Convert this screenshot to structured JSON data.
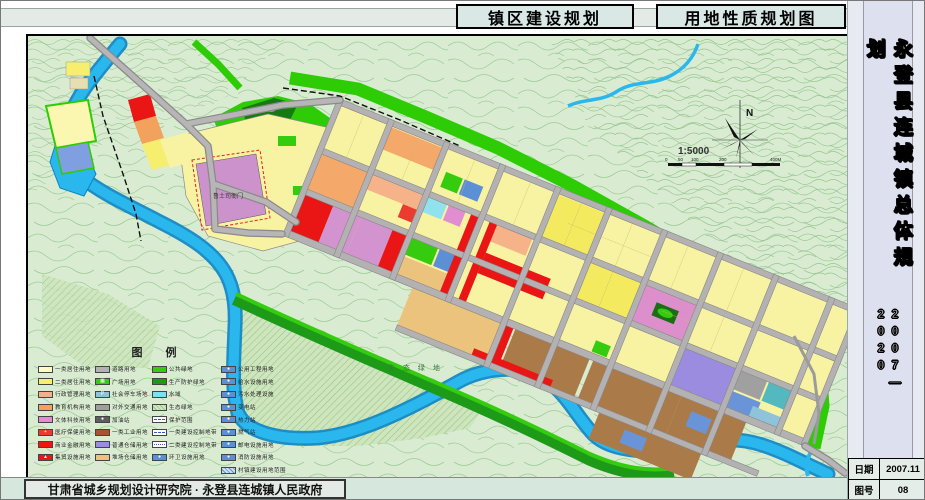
{
  "header": {
    "tabs": [
      {
        "label": "镇区建设规划"
      },
      {
        "label": "用地性质规划图"
      }
    ]
  },
  "titleblock": {
    "vertical_title": "永登县连城镇总体规划",
    "period": "2007—2020",
    "rows": [
      {
        "label": "日期",
        "value": "2007.11"
      },
      {
        "label": "图号",
        "value": "08"
      }
    ]
  },
  "footer": {
    "credit": "甘肃省城乡规划设计研究院 · 永登县连城镇人民政府"
  },
  "map": {
    "labels": {
      "heritage_site": "鲁土司衙门",
      "eco_green": "生 态 绿 地",
      "north": "N",
      "scale_ratio": "1:5000"
    },
    "scale_ticks": [
      "0",
      "50",
      "100",
      "200",
      "400M"
    ],
    "colors": {
      "river": "#2ab7ee",
      "public_green": "#35cc10",
      "protect_green": "#1d9b18",
      "residential1": "#fdfbc8",
      "residential2": "#f5ee6e",
      "commercial_red": "#ea1515",
      "culture_pink": "#dd8fcb",
      "education_orange": "#f2a25c",
      "industry_brown": "#aa7a48",
      "warehouse_purple": "#9b8ce0",
      "road_gray": "#b3b1b1",
      "utility_blue": "#5b8fd6"
    },
    "legend": {
      "title": "图    例",
      "columns": [
        [
          {
            "l": "一类居住用地",
            "f": "#fdfbc8"
          },
          {
            "l": "二类居住用地",
            "f": "#f5ee6e"
          },
          {
            "l": "行政管理用地",
            "f": "#f4b08a"
          },
          {
            "l": "教育机构用地",
            "f": "#f2a25c"
          },
          {
            "l": "文体科技用地",
            "f": "#e08ed0"
          },
          {
            "l": "医疗保健用地",
            "f": "#ea3b2e",
            "g": "+"
          },
          {
            "l": "商业金融用地",
            "f": "#ea1515"
          },
          {
            "l": "集贸设施用地",
            "f": "#ea1515",
            "g": "▲"
          }
        ],
        [
          {
            "l": "道路用地",
            "f": "#b3b1b1"
          },
          {
            "l": "广场用地",
            "f": "#35cc10",
            "g": "▦"
          },
          {
            "l": "社会停车场地",
            "f": "#8fc3d9",
            "g": "P"
          },
          {
            "l": "对外交通用地",
            "f": "#9e9e9e"
          },
          {
            "l": "加油站",
            "f": "#5e5e5e",
            "g": "●"
          },
          {
            "l": "一类工业用地",
            "f": "#a8522e"
          },
          {
            "l": "普通仓储用地",
            "f": "#9b8ce0"
          },
          {
            "l": "堆场仓储用地",
            "f": "#ecc37c"
          }
        ],
        [
          {
            "l": "公共绿地",
            "f": "#35cc10"
          },
          {
            "l": "生产防护绿地",
            "f": "#1d9b18"
          },
          {
            "l": "水域",
            "f": "#7ce0f0"
          },
          {
            "l": "生态绿地",
            "kind": "hatch-green"
          },
          {
            "l": "保护范围",
            "kind": "line-red"
          },
          {
            "l": "一类建设控制地带",
            "kind": "line-blue"
          },
          {
            "l": "二类建设控制地带",
            "kind": "line-bluedd"
          },
          {
            "l": "环卫设施用地",
            "f": "#5b8fd6",
            "g": "●"
          }
        ],
        [
          {
            "l": "公用工程用地",
            "f": "#5b8fd6",
            "g": "●"
          },
          {
            "l": "给水设施用地",
            "f": "#5b8fd6",
            "g": "●"
          },
          {
            "l": "污水处理设施",
            "f": "#5b8fd6",
            "g": "●"
          },
          {
            "l": "变电站",
            "f": "#5b8fd6",
            "g": "●"
          },
          {
            "l": "热力站",
            "f": "#5b8fd6",
            "g": "●"
          },
          {
            "l": "燃气站",
            "f": "#5b8fd6",
            "g": "●"
          },
          {
            "l": "邮电设施用地",
            "f": "#5b8fd6",
            "g": "●"
          },
          {
            "l": "消防设施用地",
            "f": "#5b8fd6",
            "g": "●"
          },
          {
            "l": "村镇建设用地范围",
            "kind": "hatch-blue"
          }
        ]
      ]
    }
  }
}
